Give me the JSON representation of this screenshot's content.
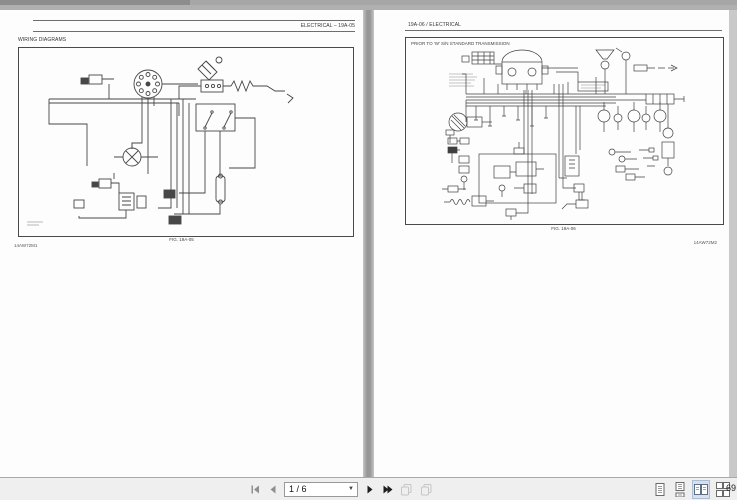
{
  "left_page": {
    "header_right": "ELECTRICAL – 19A-05",
    "section_title": "WIRING DIAGRAMS",
    "figure_caption": "FIG. 19A-05",
    "doc_code": "14AW72M1"
  },
  "right_page": {
    "header_left": "19A-06 / ELECTRICAL",
    "diagram_title": "PRIOR TO 'W' S/N STANDARD TRANSMISSION",
    "figure_caption": "FIG. 19A-06",
    "doc_code": "14AW72M2"
  },
  "toolbar": {
    "page_indicator": "1 / 6",
    "zoom_level": "69",
    "icons": {
      "first_page": "go-first-icon",
      "previous_page": "go-previous-icon",
      "next_page": "go-next-icon",
      "last_page": "go-last-icon",
      "page_duplicate_1": "page-copy-icon",
      "page_duplicate_2": "page-copy-icon",
      "single_page_view": "single-page-icon",
      "continuous_view": "continuous-page-icon",
      "facing_view": "facing-pages-icon",
      "facing_continuous_view": "facing-continuous-icon"
    }
  }
}
